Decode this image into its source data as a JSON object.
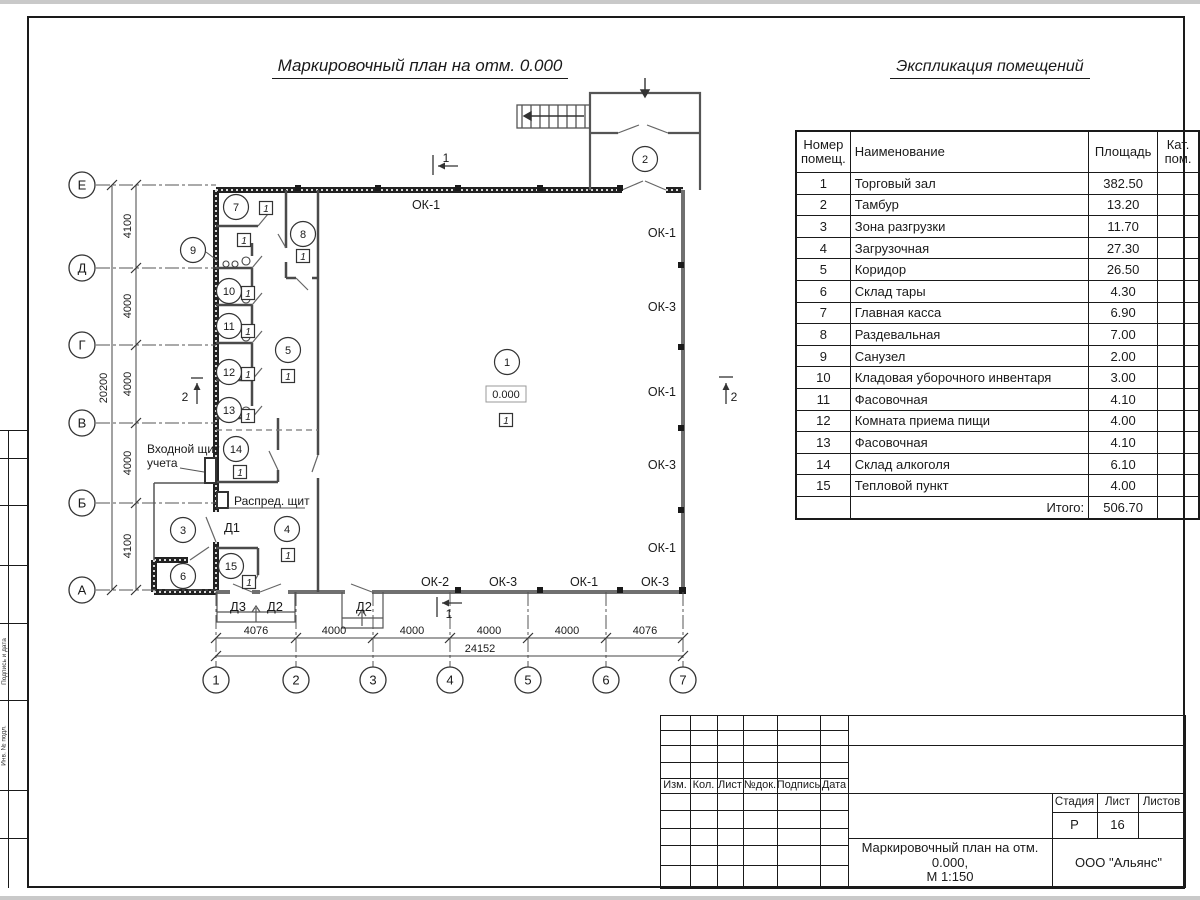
{
  "page": {
    "plan_title": "Маркировочный план на отм. 0.000",
    "table_title": "Экспликация помещений"
  },
  "explication": {
    "col_headers": {
      "num": "Номер помещ.",
      "name": "Наименование",
      "area": "Площадь",
      "cat": "Кат. пом."
    },
    "rows": [
      [
        "1",
        "Торговый зал",
        "382.50"
      ],
      [
        "2",
        "Тамбур",
        "13.20"
      ],
      [
        "3",
        "Зона разгрузки",
        "11.70"
      ],
      [
        "4",
        "Загрузочная",
        "27.30"
      ],
      [
        "5",
        "Коридор",
        "26.50"
      ],
      [
        "6",
        "Склад тары",
        "4.30"
      ],
      [
        "7",
        "Главная касса",
        "6.90"
      ],
      [
        "8",
        "Раздевальная",
        "7.00"
      ],
      [
        "9",
        "Санузел",
        "2.00"
      ],
      [
        "10",
        "Кладовая уборочного инвентаря",
        "3.00"
      ],
      [
        "11",
        "Фасовочная",
        "4.10"
      ],
      [
        "12",
        "Комната приема пищи",
        "4.00"
      ],
      [
        "13",
        "Фасовочная",
        "4.10"
      ],
      [
        "14",
        "Склад алкоголя",
        "6.10"
      ],
      [
        "15",
        "Тепловой пункт",
        "4.00"
      ]
    ],
    "total_label": "Итого:",
    "total_value": "506.70"
  },
  "plan": {
    "elevation": "0.000",
    "floor_tag": "1",
    "rooms": [
      {
        "n": "1",
        "x": 507,
        "y": 362
      },
      {
        "n": "2",
        "x": 645,
        "y": 159
      },
      {
        "n": "3",
        "x": 183,
        "y": 530
      },
      {
        "n": "4",
        "x": 287,
        "y": 529
      },
      {
        "n": "5",
        "x": 288,
        "y": 350
      },
      {
        "n": "6",
        "x": 183,
        "y": 576
      },
      {
        "n": "7",
        "x": 236,
        "y": 207
      },
      {
        "n": "8",
        "x": 303,
        "y": 234
      },
      {
        "n": "9",
        "x": 193,
        "y": 250
      },
      {
        "n": "10",
        "x": 229,
        "y": 291
      },
      {
        "n": "11",
        "x": 229,
        "y": 326
      },
      {
        "n": "12",
        "x": 229,
        "y": 372
      },
      {
        "n": "13",
        "x": 229,
        "y": 410
      },
      {
        "n": "14",
        "x": 236,
        "y": 449
      },
      {
        "n": "15",
        "x": 231,
        "y": 566
      }
    ],
    "floor_tags": [
      [
        266,
        208
      ],
      [
        244,
        240
      ],
      [
        303,
        256
      ],
      [
        248,
        293
      ],
      [
        248,
        331
      ],
      [
        248,
        374
      ],
      [
        248,
        416
      ],
      [
        240,
        472
      ],
      [
        288,
        376
      ],
      [
        506,
        420
      ],
      [
        288,
        555
      ],
      [
        249,
        582
      ]
    ],
    "window_labels": [
      {
        "t": "ОК-1",
        "x": 426,
        "y": 209,
        "a": "middle"
      },
      {
        "t": "ОК-1",
        "x": 676,
        "y": 237,
        "a": "end"
      },
      {
        "t": "ОК-3",
        "x": 676,
        "y": 311,
        "a": "end"
      },
      {
        "t": "ОК-1",
        "x": 676,
        "y": 396,
        "a": "end"
      },
      {
        "t": "ОК-3",
        "x": 676,
        "y": 469,
        "a": "end"
      },
      {
        "t": "ОК-1",
        "x": 676,
        "y": 552,
        "a": "end"
      },
      {
        "t": "ОК-2",
        "x": 435,
        "y": 586,
        "a": "middle"
      },
      {
        "t": "ОК-3",
        "x": 503,
        "y": 586,
        "a": "middle"
      },
      {
        "t": "ОК-1",
        "x": 584,
        "y": 586,
        "a": "middle"
      },
      {
        "t": "ОК-3",
        "x": 655,
        "y": 586,
        "a": "middle"
      }
    ],
    "door_labels": [
      {
        "t": "Д1",
        "x": 232,
        "y": 532
      },
      {
        "t": "Д3",
        "x": 238,
        "y": 611
      },
      {
        "t": "Д2",
        "x": 275,
        "y": 611
      },
      {
        "t": "Д2",
        "x": 364,
        "y": 611
      }
    ],
    "notes": [
      {
        "t": "Входной щит",
        "x": 147,
        "y": 453
      },
      {
        "t": "учета",
        "x": 147,
        "y": 467
      },
      {
        "t": "Распред. щит",
        "x": 234,
        "y": 505
      }
    ],
    "section_markers": [
      {
        "t": "1",
        "pos": "top"
      },
      {
        "t": "1",
        "pos": "bottom"
      },
      {
        "t": "2",
        "pos": "left"
      },
      {
        "t": "2",
        "pos": "right"
      }
    ]
  },
  "axes": {
    "left": [
      {
        "l": "Е",
        "y": 185
      },
      {
        "l": "Д",
        "y": 268
      },
      {
        "l": "Г",
        "y": 345
      },
      {
        "l": "В",
        "y": 423
      },
      {
        "l": "Б",
        "y": 503
      },
      {
        "l": "А",
        "y": 590
      }
    ],
    "bottom": [
      {
        "l": "1",
        "x": 216
      },
      {
        "l": "2",
        "x": 296
      },
      {
        "l": "3",
        "x": 373
      },
      {
        "l": "4",
        "x": 450
      },
      {
        "l": "5",
        "x": 528
      },
      {
        "l": "6",
        "x": 606
      },
      {
        "l": "7",
        "x": 683
      }
    ]
  },
  "dims": {
    "left_segments": [
      {
        "t": "4100",
        "y": 226
      },
      {
        "t": "4000",
        "y": 306
      },
      {
        "t": "4000",
        "y": 384
      },
      {
        "t": "4000",
        "y": 463
      },
      {
        "t": "4100",
        "y": 546
      }
    ],
    "left_total": {
      "t": "20200",
      "y": 388
    },
    "bottom_segments": [
      {
        "t": "4076",
        "x": 256
      },
      {
        "t": "4000",
        "x": 334
      },
      {
        "t": "4000",
        "x": 412
      },
      {
        "t": "4000",
        "x": 489
      },
      {
        "t": "4000",
        "x": 567
      },
      {
        "t": "4076",
        "x": 645
      }
    ],
    "bottom_total": {
      "t": "24152",
      "x": 480
    }
  },
  "title_block": {
    "rev_headers": [
      "Изм.",
      "Кол.",
      "Лист",
      "№док.",
      "Подпись",
      "Дата"
    ],
    "stage_label": "Стадия",
    "stage_value": "Р",
    "sheet_label": "Лист",
    "sheet_value": "16",
    "sheets_label": "Листов",
    "sheets_value": "",
    "doc_title_1": "Маркировочный план на отм. 0.000,",
    "doc_title_2": "М 1:150",
    "company": "ООО \"Альянс\""
  },
  "side_stamp": {
    "labels": [
      "Подпись и дата",
      "Инв. № подл."
    ]
  }
}
